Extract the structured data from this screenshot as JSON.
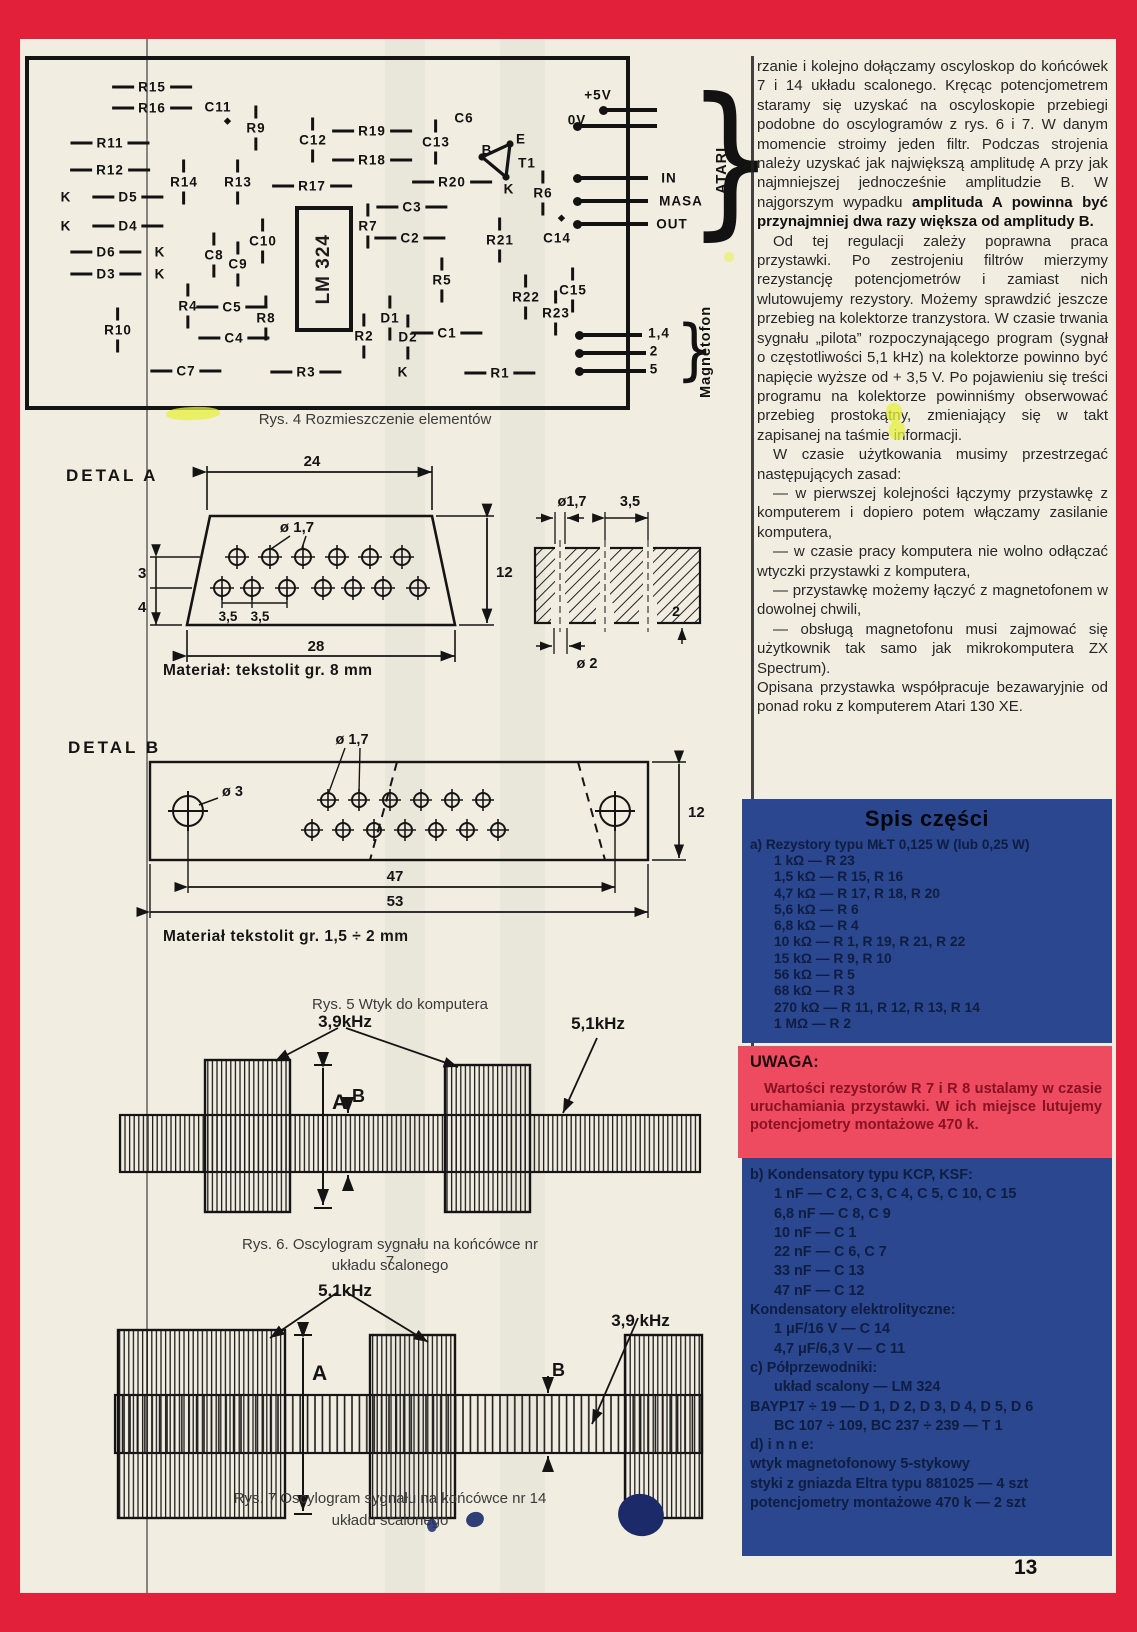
{
  "page": {
    "number": "13"
  },
  "pcb": {
    "caption": "Rys. 4 Rozmieszczenie elementów",
    "ic_label": "LM 324",
    "atari_label": "ATARI",
    "magnetofon_label": "Magnetofon",
    "labels": [
      {
        "t": "R15",
        "x": 152,
        "y": 87,
        "o": "h"
      },
      {
        "t": "R16",
        "x": 152,
        "y": 108,
        "o": "h"
      },
      {
        "t": "C11",
        "x": 218,
        "y": 107,
        "o": "plain"
      },
      {
        "t": "◆",
        "x": 228,
        "y": 121,
        "o": "dm"
      },
      {
        "t": "R9",
        "x": 256,
        "y": 128,
        "o": "v"
      },
      {
        "t": "C12",
        "x": 313,
        "y": 140,
        "o": "v"
      },
      {
        "t": "R19",
        "x": 372,
        "y": 131,
        "o": "h"
      },
      {
        "t": "C13",
        "x": 436,
        "y": 142,
        "o": "v"
      },
      {
        "t": "C6",
        "x": 464,
        "y": 118,
        "o": "plain"
      },
      {
        "t": "R18",
        "x": 372,
        "y": 160,
        "o": "h"
      },
      {
        "t": "R11",
        "x": 110,
        "y": 143,
        "o": "h"
      },
      {
        "t": "R12",
        "x": 110,
        "y": 170,
        "o": "h"
      },
      {
        "t": "R14",
        "x": 184,
        "y": 182,
        "o": "v"
      },
      {
        "t": "R13",
        "x": 238,
        "y": 182,
        "o": "v"
      },
      {
        "t": "R17",
        "x": 312,
        "y": 186,
        "o": "h"
      },
      {
        "t": "R20",
        "x": 452,
        "y": 182,
        "o": "h"
      },
      {
        "t": "K",
        "x": 66,
        "y": 197,
        "o": "plain"
      },
      {
        "t": "D5",
        "x": 128,
        "y": 197,
        "o": "h"
      },
      {
        "t": "K",
        "x": 66,
        "y": 226,
        "o": "plain"
      },
      {
        "t": "D4",
        "x": 128,
        "y": 226,
        "o": "h"
      },
      {
        "t": "D6",
        "x": 106,
        "y": 252,
        "o": "h"
      },
      {
        "t": "K",
        "x": 160,
        "y": 252,
        "o": "plain"
      },
      {
        "t": "D3",
        "x": 106,
        "y": 274,
        "o": "h"
      },
      {
        "t": "K",
        "x": 160,
        "y": 274,
        "o": "plain"
      },
      {
        "t": "C8",
        "x": 214,
        "y": 255,
        "o": "v"
      },
      {
        "t": "C9",
        "x": 238,
        "y": 264,
        "o": "v"
      },
      {
        "t": "C10",
        "x": 263,
        "y": 241,
        "o": "v"
      },
      {
        "t": "R10",
        "x": 118,
        "y": 330,
        "o": "v"
      },
      {
        "t": "R4",
        "x": 188,
        "y": 306,
        "o": "v"
      },
      {
        "t": "C5",
        "x": 232,
        "y": 307,
        "o": "h"
      },
      {
        "t": "R8",
        "x": 266,
        "y": 318,
        "o": "v"
      },
      {
        "t": "C4",
        "x": 234,
        "y": 338,
        "o": "h"
      },
      {
        "t": "C7",
        "x": 186,
        "y": 371,
        "o": "h"
      },
      {
        "t": "R3",
        "x": 306,
        "y": 372,
        "o": "h"
      },
      {
        "t": "R2",
        "x": 364,
        "y": 336,
        "o": "v"
      },
      {
        "t": "R7",
        "x": 368,
        "y": 226,
        "o": "v"
      },
      {
        "t": "C3",
        "x": 412,
        "y": 207,
        "o": "h"
      },
      {
        "t": "C2",
        "x": 410,
        "y": 238,
        "o": "h"
      },
      {
        "t": "R5",
        "x": 442,
        "y": 280,
        "o": "v"
      },
      {
        "t": "B",
        "x": 487,
        "y": 150,
        "o": "plain"
      },
      {
        "t": "E",
        "x": 521,
        "y": 139,
        "o": "plain"
      },
      {
        "t": "T1",
        "x": 527,
        "y": 163,
        "o": "plain"
      },
      {
        "t": "K",
        "x": 509,
        "y": 189,
        "o": "plain"
      },
      {
        "t": "R6",
        "x": 543,
        "y": 193,
        "o": "v"
      },
      {
        "t": "R21",
        "x": 500,
        "y": 240,
        "o": "v"
      },
      {
        "t": "C14",
        "x": 557,
        "y": 238,
        "o": "plain"
      },
      {
        "t": "◆",
        "x": 562,
        "y": 218,
        "o": "dm"
      },
      {
        "t": "R22",
        "x": 526,
        "y": 297,
        "o": "v"
      },
      {
        "t": "C15",
        "x": 573,
        "y": 290,
        "o": "v"
      },
      {
        "t": "R23",
        "x": 556,
        "y": 313,
        "o": "v"
      },
      {
        "t": "D1",
        "x": 390,
        "y": 318,
        "o": "v"
      },
      {
        "t": "D2",
        "x": 408,
        "y": 337,
        "o": "v"
      },
      {
        "t": "C1",
        "x": 447,
        "y": 333,
        "o": "h"
      },
      {
        "t": "K",
        "x": 403,
        "y": 372,
        "o": "plain"
      },
      {
        "t": "R1",
        "x": 500,
        "y": 373,
        "o": "h"
      },
      {
        "t": "+5V",
        "x": 598,
        "y": 95,
        "o": "plain"
      },
      {
        "t": "0V",
        "x": 577,
        "y": 120,
        "o": "plain"
      },
      {
        "t": "IN",
        "x": 669,
        "y": 178,
        "o": "plain"
      },
      {
        "t": "MASA",
        "x": 681,
        "y": 201,
        "o": "plain"
      },
      {
        "t": "OUT",
        "x": 672,
        "y": 224,
        "o": "plain"
      },
      {
        "t": "1,4",
        "x": 659,
        "y": 333,
        "o": "plain"
      },
      {
        "t": "2",
        "x": 654,
        "y": 351,
        "o": "plain"
      },
      {
        "t": "5",
        "x": 654,
        "y": 369,
        "o": "plain"
      }
    ]
  },
  "detal_a": {
    "title": "DETAL A",
    "material": "Materiał:  tekstolit  gr. 8 mm",
    "dims": {
      "top": "24",
      "height": "12",
      "bottom": "28",
      "left_upper": "3",
      "left_lower": "4",
      "pitch_a": "3,5",
      "pitch_b": "3,5",
      "hole": "ø 1,7"
    },
    "section": {
      "hole_top": "ø1,7",
      "pitch": "3,5",
      "hole_bottom": "ø 2",
      "depth": "2"
    }
  },
  "detal_b": {
    "title": "DETAL B",
    "material": "Materiał   tekstolit  gr. 1,5 ÷ 2 mm",
    "dims": {
      "hole_big": "ø 3",
      "hole_small": "ø 1,7",
      "height": "12",
      "inner": "47",
      "outer": "53"
    }
  },
  "fig5": {
    "caption": "Rys. 5 Wtyk do komputera"
  },
  "fig6": {
    "caption_line1": "Rys. 6. Oscylogram sygnału na końcówce nr 7",
    "caption_line2": "układu scalonego",
    "freq_high": "3,9kHz",
    "freq_low": "5,1kHz",
    "amp_a": "A",
    "amp_b": "B"
  },
  "fig7": {
    "caption_line1": "Rys. 7 Oscylogram sygnału na końcówce nr 14",
    "caption_line2": "układu scalonego",
    "freq_high": "5,1kHz",
    "freq_low": "3,9 kHz",
    "amp_a": "A",
    "amp_b": "B"
  },
  "article": {
    "p1": "rzanie i kolejno dołączamy oscyloskop do końcówek 7 i 14 układu scalonego. Kręcąc potencjometrem staramy się uzyskać na oscyloskopie przebiegi podobne do oscylogramów z rys. 6 i 7. W danym momencie stroimy jeden filtr. Podczas strojenia należy uzyskać jak największą amplitudę A przy jak najmniejszej jednocześnie amplitudzie B. W najgorszym wypadku ",
    "p1_bold": "amplituda A powinna być przynajmniej dwa razy większa od amplitudy B.",
    "p2": "Od tej regulacji zależy poprawna praca przystawki. Po zestrojeniu filtrów mierzymy rezystancję potencjometrów i zamiast nich wlutowujemy rezystory. Możemy sprawdzić jeszcze przebieg na kolektorze tranzystora. W czasie trwania sygnału „pilota” rozpoczynającego program (sygnał o częstotliwości 5,1 kHz) na kolektorze powinno być napięcie wyższe od + 3,5 V. Po pojawieniu się treści programu na kolektorze powinniśmy obserwować przebieg prostokątny, zmieniający się w takt zapisanej na taśmie informacji.",
    "p3": "W czasie użytkowania musimy przestrzegać następujących zasad:",
    "bullets": [
      "— w pierwszej kolejności łączymy przystawkę z komputerem i dopiero potem włączamy zasilanie komputera,",
      "— w czasie pracy komputera nie wolno odłączać wtyczki przystawki z komputera,",
      "— przystawkę możemy łączyć z magnetofonem w dowolnej chwili,",
      "— obsługą magnetofonu musi zajmować się użytkownik tak samo jak mikrokomputera ZX Spectrum)."
    ],
    "p4": "Opisana przystawka współpracuje bezawaryjnie od ponad roku z komputerem Atari 130 XE."
  },
  "parts": {
    "title": "Spis części",
    "resistors_header": "a) Rezystory typu MŁT 0,125 W (lub 0,25 W)",
    "resistors": [
      "1 kΩ — R 23",
      "1,5 kΩ — R 15, R 16",
      "4,7 kΩ — R 17, R 18, R 20",
      "5,6 kΩ — R 6",
      "6,8 kΩ — R 4",
      "10 kΩ — R 1, R 19, R 21, R 22",
      "15 kΩ — R 9, R 10",
      "56 kΩ — R 5",
      "68 kΩ — R 3",
      "270 kΩ — R 11, R 12, R 13, R 14",
      "1 MΩ — R 2"
    ]
  },
  "uwaga": {
    "title": "UWAGA:",
    "body": "Wartości rezystorów R 7 i R 8 ustalamy w czasie uruchamiania przystawki. W ich miejsce lutujemy potencjometry montażowe 470 k."
  },
  "parts2": {
    "lines": [
      {
        "t": "b) Kondensatory typu KCP, KSF:",
        "ind": 0
      },
      {
        "t": "1 nF — C 2, C 3, C 4, C 5, C 10, C 15",
        "ind": 1
      },
      {
        "t": "6,8 nF — C 8, C 9",
        "ind": 1
      },
      {
        "t": "10 nF — C 1",
        "ind": 1
      },
      {
        "t": "22 nF — C 6, C 7",
        "ind": 1
      },
      {
        "t": "33 nF — C 13",
        "ind": 1
      },
      {
        "t": "47 nF — C 12",
        "ind": 1
      },
      {
        "t": "Kondensatory elektrolityczne:",
        "ind": 0
      },
      {
        "t": "1 μF/16 V — C 14",
        "ind": 1
      },
      {
        "t": "4,7 μF/6,3 V — C 11",
        "ind": 1
      },
      {
        "t": "c) Półprzewodniki:",
        "ind": 0
      },
      {
        "t": "układ scalony — LM 324",
        "ind": 1
      },
      {
        "t": "BAYP17 ÷ 19 — D 1, D 2, D 3, D 4, D 5, D 6",
        "ind": 0
      },
      {
        "t": "BC 107 ÷ 109, BC 237 ÷ 239 — T 1",
        "ind": 1
      },
      {
        "t": "d) i n n e:",
        "ind": 0
      },
      {
        "t": "wtyk magnetofonowy 5-stykowy",
        "ind": 0
      },
      {
        "t": "styki z gniazda Eltra typu 881025 — 4 szt",
        "ind": 0
      },
      {
        "t": "potencjometry montażowe 470 k — 2 szt",
        "ind": 0
      }
    ]
  },
  "colors": {
    "frame_red": "#e2203a",
    "paper": "#f1eee1",
    "box_blue": "#2a4790",
    "uwaga_pink": "#ee4b61",
    "highlight_yellow": "#e6f03c"
  }
}
